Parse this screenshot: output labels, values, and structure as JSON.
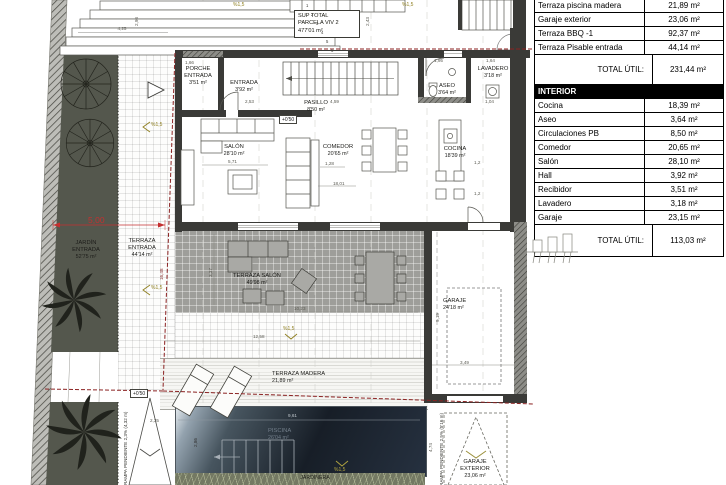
{
  "area_table": {
    "exterior_rows": [
      {
        "label": "Terraza piscina madera",
        "value": "21,89 m²"
      },
      {
        "label": "Garaje exterior",
        "value": "23,06 m²"
      },
      {
        "label": "Terraza BBQ -1",
        "value": "92,37 m²"
      },
      {
        "label": "Terraza Pisable entrada",
        "value": "44,14 m²"
      }
    ],
    "exterior_total_label": "TOTAL ÚTIL:",
    "exterior_total_value": "231,44 m²",
    "interior_header": "INTERIOR",
    "interior_rows": [
      {
        "label": "Cocina",
        "value": "18,39 m²"
      },
      {
        "label": "Aseo",
        "value": "3,64 m²"
      },
      {
        "label": "Circulaciones PB",
        "value": "8,50 m²"
      },
      {
        "label": "Comedor",
        "value": "20,65 m²"
      },
      {
        "label": "Salón",
        "value": "28,10 m²"
      },
      {
        "label": "Hall",
        "value": "3,92 m²"
      },
      {
        "label": "Recibidor",
        "value": "3,51 m²"
      },
      {
        "label": "Lavadero",
        "value": "3,18 m²"
      },
      {
        "label": "Garaje",
        "value": "23,15 m²"
      }
    ],
    "interior_total_label": "TOTAL ÚTIL:",
    "interior_total_value": "113,03 m²"
  },
  "plan": {
    "parcel_box": {
      "l1": "SUP TOTAL",
      "l2": "PARCELA VIV 2",
      "l3": "477'01 m²"
    },
    "rooms": {
      "porche": {
        "l1": "PORCHE",
        "l2": "ENTRADA",
        "area": "3'51 m²"
      },
      "entrada": {
        "l1": "ENTRADA",
        "area": "3'92 m²"
      },
      "pasillo": {
        "l1": "PASILLO",
        "area": "8'50 m²"
      },
      "aseo": {
        "l1": "ASEO",
        "area": "3'64 m²"
      },
      "lavadero": {
        "l1": "LAVADERO",
        "area": "3'18 m²"
      },
      "salon": {
        "l1": "SALÓN",
        "area": "28'10 m²"
      },
      "comedor": {
        "l1": "COMEDOR",
        "area": "20'65 m²"
      },
      "cocina": {
        "l1": "COCINA",
        "area": "18'39 m²"
      },
      "jardin_entrada": {
        "l1": "JARDÍN",
        "l2": "ENTRADA",
        "area": "52'75 m²"
      },
      "terraza_entrada": {
        "l1": "TERRAZA",
        "l2": "ENTRADA",
        "area": "44'14 m²"
      },
      "terraza_salon": {
        "l1": "TERRAZA SALÓN",
        "area": "49'98 m²"
      },
      "terraza_madera": {
        "l1": "TERRAZA MADERA",
        "area": "21,89 m²"
      },
      "piscina": {
        "l1": "PISCINA",
        "area": "26'04 m²"
      },
      "jardinera": {
        "l1": "JARDINERA"
      },
      "garaje": {
        "l1": "GARAJE",
        "area": "24'18 m²"
      },
      "garaje_exterior": {
        "l1": "GARAJE",
        "l2": "EXTERIOR",
        "area": "23,06 m²"
      }
    },
    "level_mark": "+0'50",
    "slope_mark": "%1,5",
    "ramp_left": "RAMPA PENDIENTE 2,3% (4,32 m)",
    "ramp_right": "RAMPA PENDIENTE 2,5% (5'16 m)",
    "step_numbers": [
      "1",
      "2",
      "3",
      "4",
      "5",
      "6"
    ],
    "dims": {
      "d425": "4,25",
      "d298": "2,98",
      "d243": "2,43",
      "d253": "2,53",
      "d459": "4,59",
      "d166": "1,66",
      "d571": "5,71",
      "d128": "1,28",
      "d1801": "18,01",
      "d337": "3,37",
      "d1023": "10,23",
      "d1258": "12,58",
      "d500": "5,00",
      "d1648": "16,48",
      "d961": "9,61",
      "d286": "2,86",
      "d474": "4,74",
      "d235": "2,35",
      "d349": "3,49",
      "d919": "9,19",
      "d12": "1,2",
      "d195": "1,95",
      "d164": "1,64",
      "d104": "1,04"
    },
    "colors": {
      "boundary_red": "#8b2222",
      "slope_olive": "#8f7f1f",
      "garden_green": "#54574d",
      "terrace_gray": "#9e9e9a"
    }
  }
}
